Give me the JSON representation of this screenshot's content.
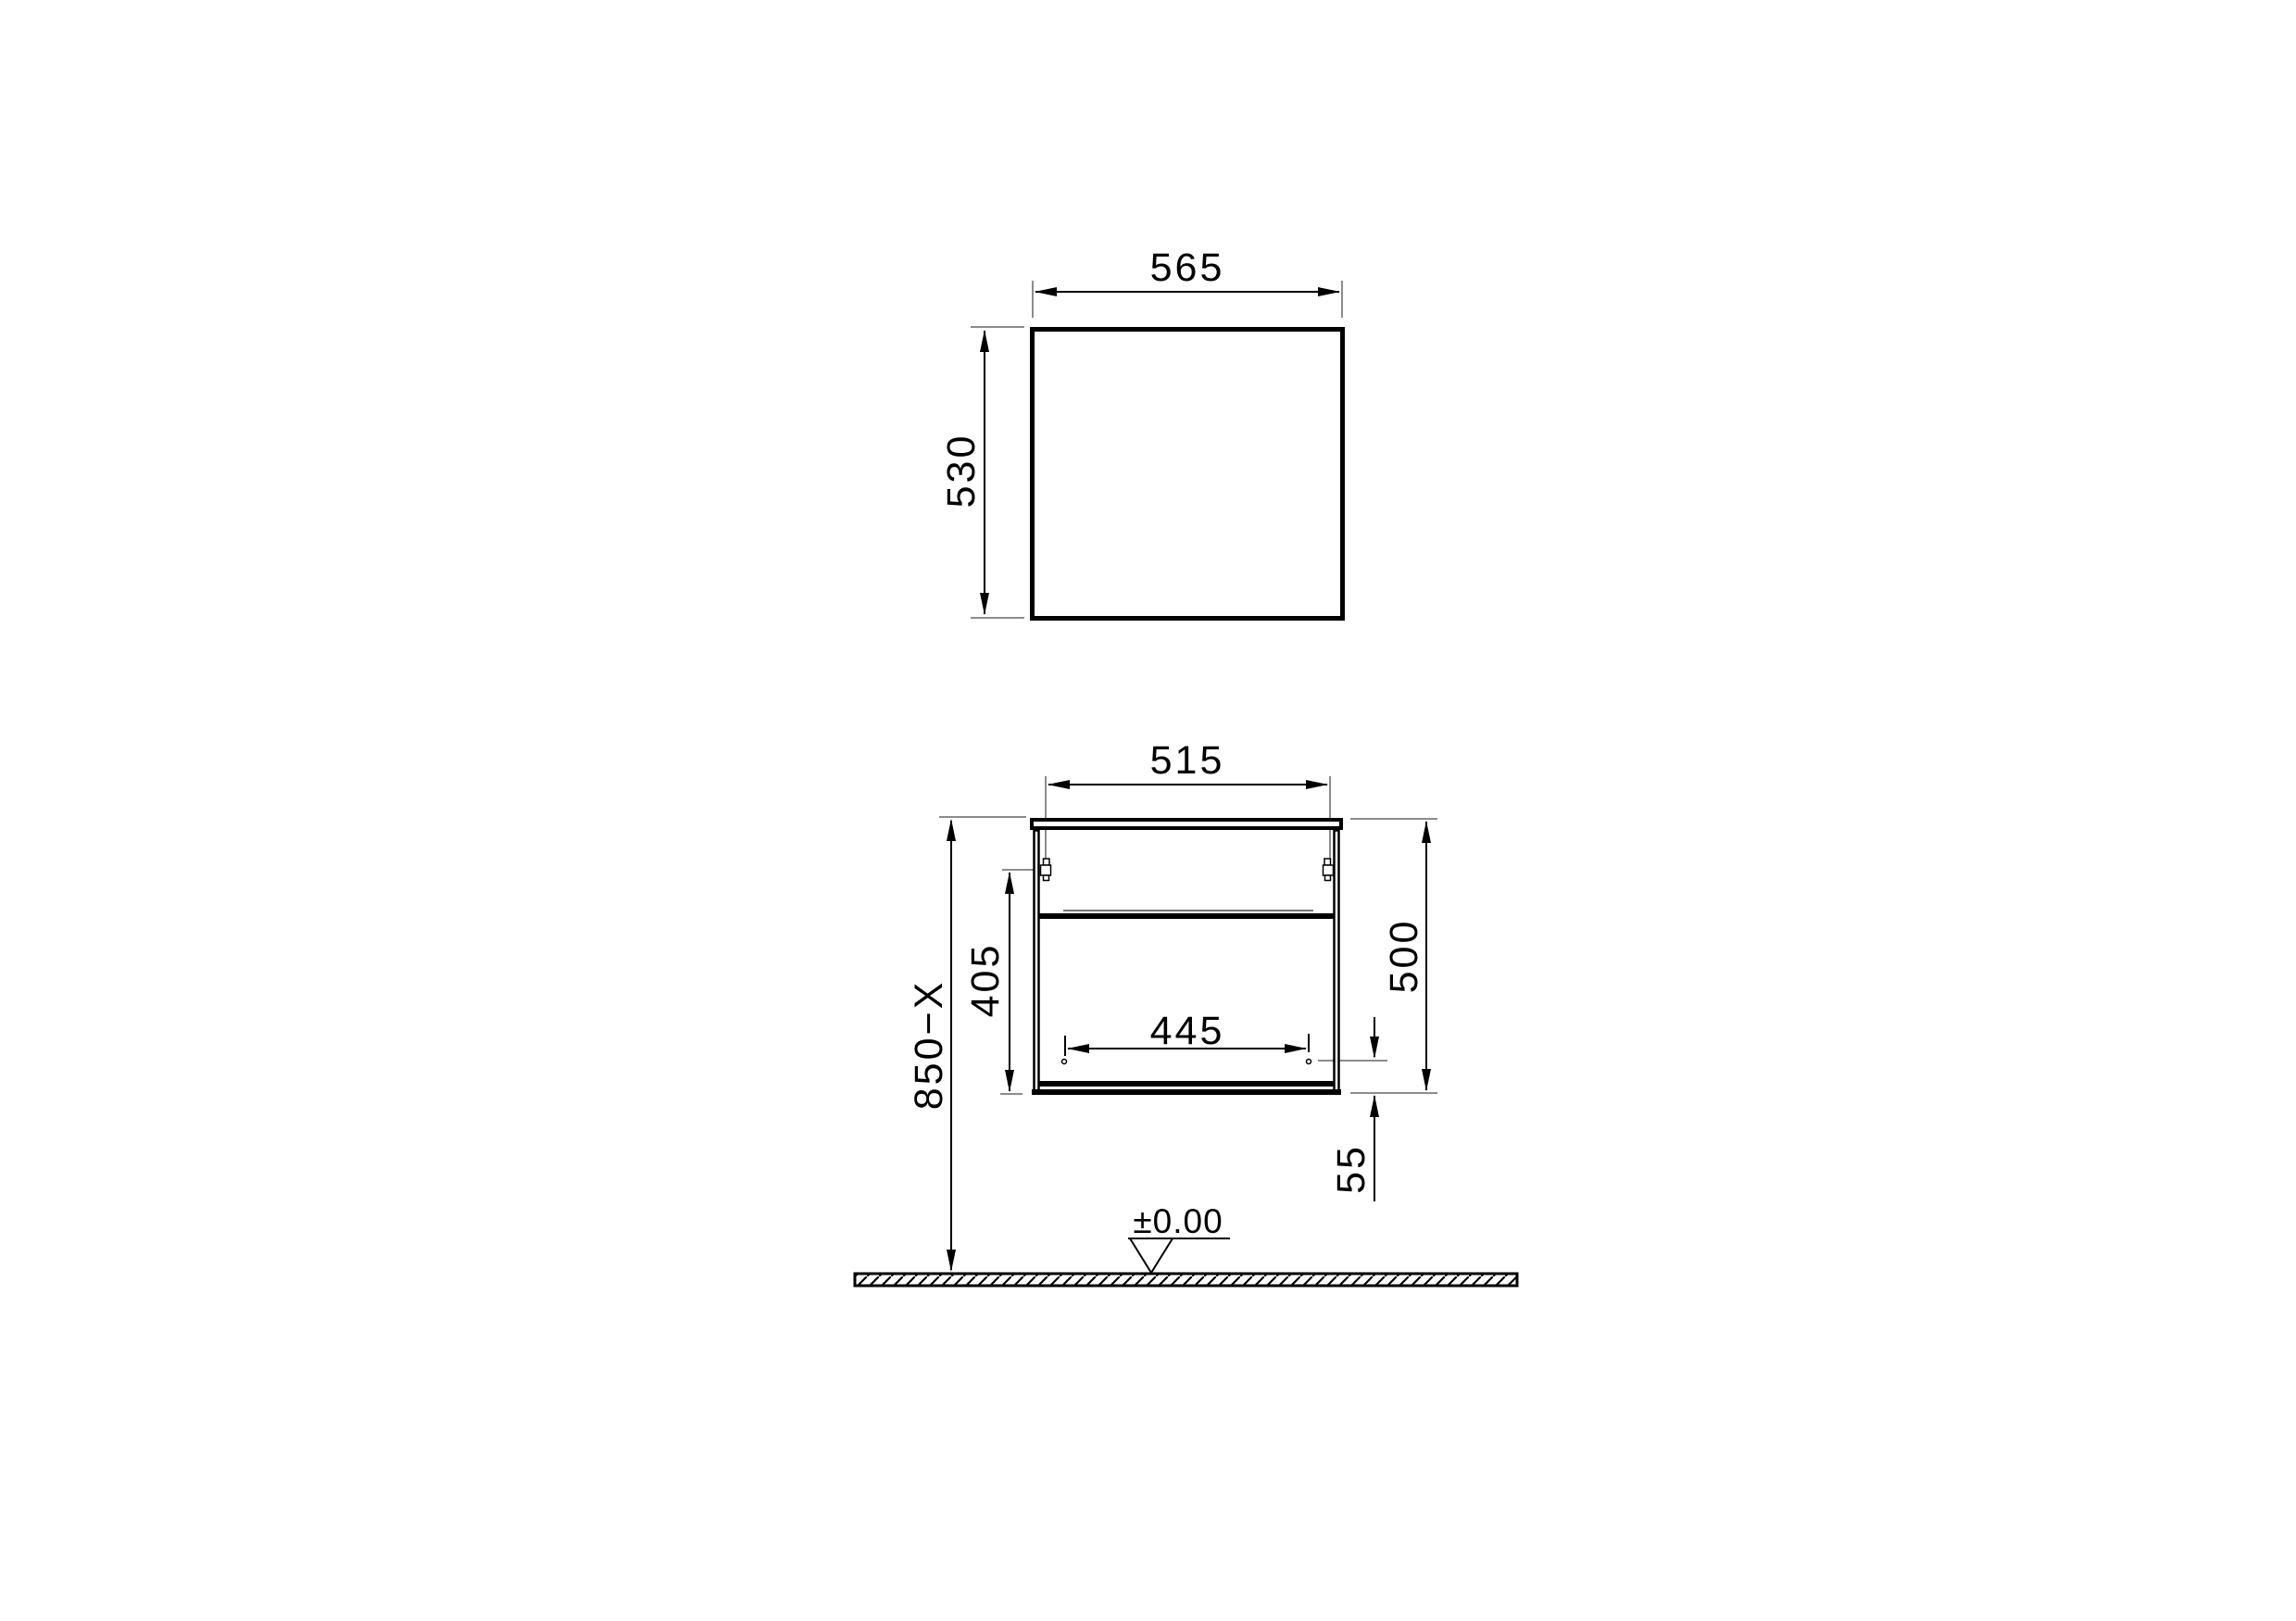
{
  "drawing_title": "vanity-unit-dimension-drawing",
  "top_view": {
    "width_dim": "565",
    "depth_dim": "530"
  },
  "front_view": {
    "opening_width_dim": "515",
    "height_dim": "500",
    "interior_height_dim": "405",
    "drawer_width_dim": "445",
    "bottom_offset_dim": "55",
    "mounting_height_dim": "850−X"
  },
  "floor": {
    "level_dim": "±0.00"
  },
  "colors": {
    "object_line": "#000000",
    "extension_line": "#8c8c8c",
    "background": "#ffffff"
  }
}
